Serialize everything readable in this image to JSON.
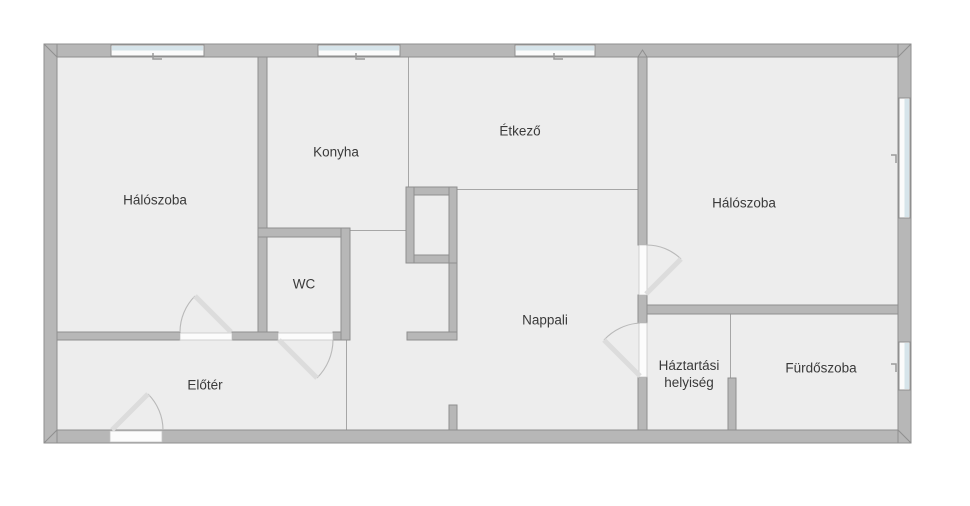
{
  "plan": {
    "type": "apartment-floor-plan",
    "language": "Hungarian"
  },
  "rooms": [
    {
      "id": "bedroom-left",
      "name": "Hálószoba",
      "cx": 155,
      "cy": 200
    },
    {
      "id": "kitchen",
      "name": "Konyha",
      "cx": 336,
      "cy": 152
    },
    {
      "id": "dining",
      "name": "Étkező",
      "cx": 520,
      "cy": 131
    },
    {
      "id": "bedroom-right",
      "name": "Hálószoba",
      "cx": 744,
      "cy": 203
    },
    {
      "id": "wc",
      "name": "WC",
      "cx": 304,
      "cy": 284
    },
    {
      "id": "living",
      "name": "Nappali",
      "cx": 545,
      "cy": 320
    },
    {
      "id": "hall",
      "name": "Előtér",
      "cx": 205,
      "cy": 385
    },
    {
      "id": "utility",
      "name": "Háztartási helyiség",
      "cx": 689,
      "cy": 374,
      "wrap": true
    },
    {
      "id": "bathroom",
      "name": "Fürdőszoba",
      "cx": 821,
      "cy": 368
    }
  ],
  "palette": {
    "background": "#ffffff",
    "floor": "#ededed",
    "wall_fill": "#b7b7b7",
    "wall_stroke": "#8f8f8f",
    "thin_line": "#a6a6a6",
    "window_base": "#fbfbfb",
    "window_glass": "#d6e4ea",
    "opening_fill": "#fcfcfc",
    "opening_stroke": "#c4c4c4",
    "door_leaf": "#dcdcdc",
    "door_arc": "#b9b9b9",
    "label_color": "#3a3a3a"
  },
  "geometry": {
    "floor": {
      "x": 57,
      "y": 57,
      "w": 841,
      "h": 373
    },
    "walls": [
      {
        "id": "ext-top",
        "x": 44,
        "y": 44,
        "w": 867,
        "h": 13
      },
      {
        "id": "ext-bottom",
        "x": 44,
        "y": 430,
        "w": 867,
        "h": 13
      },
      {
        "id": "ext-left",
        "x": 44,
        "y": 44,
        "w": 13,
        "h": 399
      },
      {
        "id": "ext-right",
        "x": 898,
        "y": 44,
        "w": 13,
        "h": 399
      },
      {
        "id": "divider-bedroom1",
        "x": 258,
        "y": 57,
        "w": 9,
        "h": 276
      },
      {
        "id": "hall-wall-a",
        "x": 57,
        "y": 332,
        "w": 123,
        "h": 8
      },
      {
        "id": "hall-wall-b",
        "x": 232,
        "y": 332,
        "w": 46,
        "h": 8
      },
      {
        "id": "hall-wall-c",
        "x": 333,
        "y": 332,
        "w": 17,
        "h": 8
      },
      {
        "id": "wc-top",
        "x": 258,
        "y": 228,
        "w": 92,
        "h": 9
      },
      {
        "id": "wc-right",
        "x": 341,
        "y": 228,
        "w": 9,
        "h": 112
      },
      {
        "id": "shaft-top",
        "x": 406,
        "y": 187,
        "w": 51,
        "h": 8
      },
      {
        "id": "shaft-bottom",
        "x": 406,
        "y": 255,
        "w": 51,
        "h": 8
      },
      {
        "id": "shaft-left",
        "x": 406,
        "y": 187,
        "w": 8,
        "h": 76
      },
      {
        "id": "shaft-right",
        "x": 449,
        "y": 187,
        "w": 8,
        "h": 76
      },
      {
        "id": "shaft-leg",
        "x": 449,
        "y": 263,
        "w": 8,
        "h": 77
      },
      {
        "id": "shaft-foot",
        "x": 407,
        "y": 332,
        "w": 50,
        "h": 8
      },
      {
        "id": "living-stub",
        "x": 449,
        "y": 405,
        "w": 8,
        "h": 25
      },
      {
        "id": "living-wall-a",
        "x": 638,
        "y": 57,
        "w": 9,
        "h": 188
      },
      {
        "id": "living-wall-b",
        "x": 638,
        "y": 295,
        "w": 9,
        "h": 28
      },
      {
        "id": "living-wall-c",
        "x": 638,
        "y": 377,
        "w": 9,
        "h": 53
      },
      {
        "id": "bedroom2-bottom",
        "x": 647,
        "y": 305,
        "w": 251,
        "h": 9
      },
      {
        "id": "bath-divider",
        "x": 728,
        "y": 378,
        "w": 8,
        "h": 52
      }
    ],
    "thin_lines": [
      {
        "id": "kitchen-dining",
        "x": 408,
        "y": 57,
        "w": 1,
        "h": 130
      },
      {
        "id": "dining-living",
        "x": 457,
        "y": 189,
        "w": 183,
        "h": 1
      },
      {
        "id": "kitchen-pass",
        "x": 350,
        "y": 230,
        "w": 56,
        "h": 1
      },
      {
        "id": "hall-living",
        "x": 346,
        "y": 340,
        "w": 1,
        "h": 90
      },
      {
        "id": "utility-bath",
        "x": 730,
        "y": 314,
        "w": 1,
        "h": 64
      }
    ],
    "windows": [
      {
        "id": "bedroom1-window",
        "x": 111,
        "y": 45,
        "w": 93,
        "h": 11,
        "side": "top"
      },
      {
        "id": "kitchen-window",
        "x": 318,
        "y": 45,
        "w": 82,
        "h": 11,
        "side": "top"
      },
      {
        "id": "dining-window",
        "x": 515,
        "y": 45,
        "w": 80,
        "h": 11,
        "side": "top"
      },
      {
        "id": "bedroom2-window",
        "x": 899,
        "y": 98,
        "w": 11,
        "h": 120,
        "side": "right"
      },
      {
        "id": "bathroom-window",
        "x": 899,
        "y": 342,
        "w": 11,
        "h": 48,
        "side": "right"
      }
    ],
    "window_ticks": [
      {
        "d": "M153 53 v6 h9"
      },
      {
        "d": "M356 53 v6 h9"
      },
      {
        "d": "M554 53 v6 h9"
      },
      {
        "d": "M891 155 h5 v8"
      },
      {
        "d": "M891 364 h5 v8"
      }
    ],
    "doors": [
      {
        "id": "entrance-door",
        "opening": {
          "x": 110,
          "y": 431,
          "w": 52,
          "h": 11
        },
        "leaf": {
          "x1": 112,
          "y1": 430,
          "x2": 148,
          "y2": 394
        },
        "arc": "M148 394 A51 51 0 0 1 163 430"
      },
      {
        "id": "bedroom1-door",
        "opening": {
          "x": 180,
          "y": 333,
          "w": 52,
          "h": 7
        },
        "leaf": {
          "x1": 231,
          "y1": 332,
          "x2": 195,
          "y2": 296
        },
        "arc": "M195 296 A51 51 0 0 0 180 332"
      },
      {
        "id": "wc-door",
        "opening": {
          "x": 278,
          "y": 333,
          "w": 55,
          "h": 7
        },
        "leaf": {
          "x1": 279,
          "y1": 340,
          "x2": 317,
          "y2": 378
        },
        "arc": "M317 378 A54 54 0 0 0 333 340"
      },
      {
        "id": "bedroom2-door",
        "opening": {
          "x": 639,
          "y": 245,
          "w": 8,
          "h": 50
        },
        "leaf": {
          "x1": 646,
          "y1": 294,
          "x2": 681,
          "y2": 259
        },
        "arc": "M646 245 A49 49 0 0 1 681 259"
      },
      {
        "id": "utility-door",
        "opening": {
          "x": 639,
          "y": 323,
          "w": 8,
          "h": 54
        },
        "leaf": {
          "x1": 640,
          "y1": 376,
          "x2": 604,
          "y2": 340
        },
        "arc": "M640 323 A53 53 0 0 0 604 340"
      }
    ],
    "corner_miters": [
      {
        "d": "M44 44 L57 57"
      },
      {
        "d": "M911 44 L898 57"
      },
      {
        "d": "M911 443 L898 430"
      },
      {
        "d": "M44 443 L57 430"
      },
      {
        "d": "M638 57 L642.5 50 L647 57"
      }
    ]
  }
}
